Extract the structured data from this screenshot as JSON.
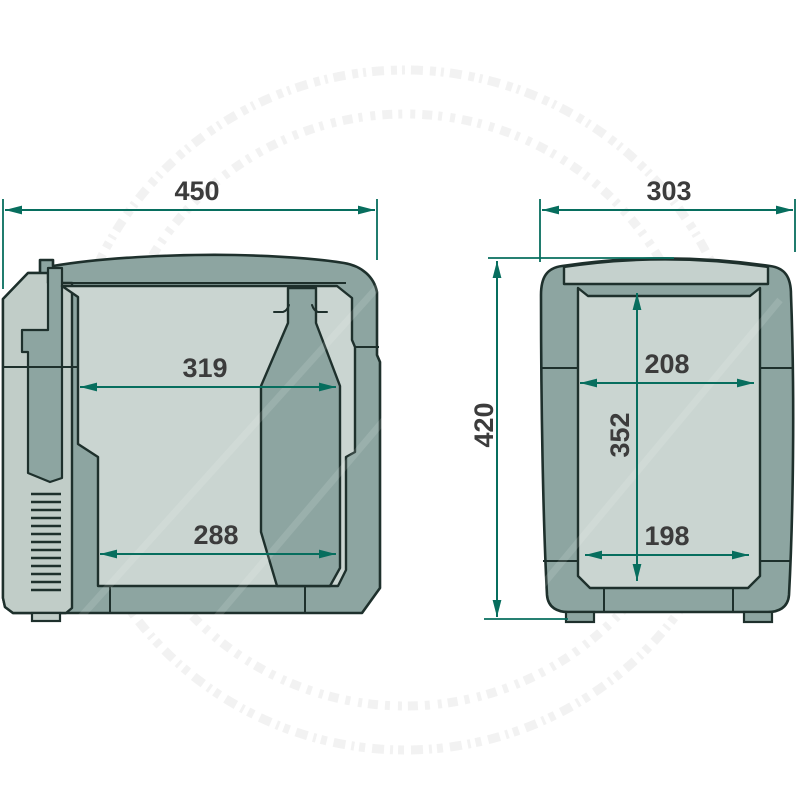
{
  "diagram": {
    "title": "Cool box dimension drawing",
    "views": {
      "side_section": {
        "label": "side section view"
      },
      "front_section": {
        "label": "front section view"
      }
    }
  },
  "dims": {
    "overall_width": "450",
    "overall_depth": "303",
    "overall_height": "420",
    "interior_width_rim": "319",
    "interior_width_floor": "288",
    "interior_depth_rim": "208",
    "interior_depth_floor": "198",
    "interior_height": "352"
  },
  "colors": {
    "bg": "#ffffff",
    "body-wall": "#8da5a1",
    "liner": "#cad5d1",
    "lid-strip": "#c5d1cd",
    "rear-panel": "#c1cdc8",
    "outline": "#1e302c",
    "dimension-line": "#076e5e",
    "label-text": "#3c3c3c",
    "watermark": "#ededed"
  }
}
